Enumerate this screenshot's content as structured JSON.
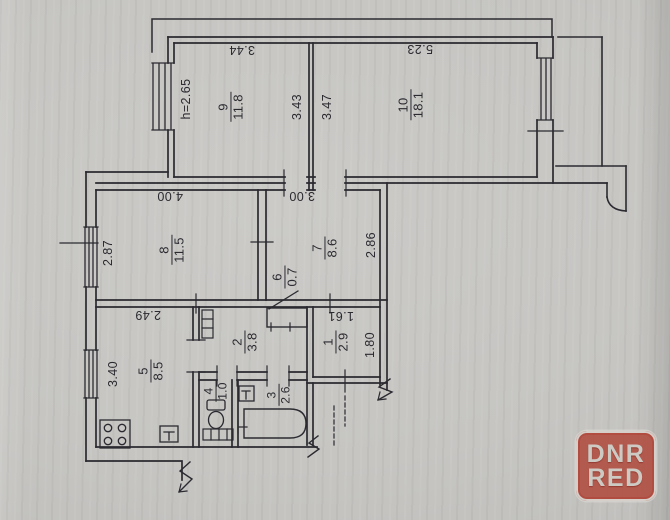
{
  "document": {
    "type": "apartment floor plan (BTI scan)",
    "line_color": "#2b2a30",
    "paper_color": "#c6c5c2"
  },
  "rooms": {
    "r1": {
      "number": "1",
      "area": "2.9"
    },
    "r2": {
      "number": "2",
      "area": "3.8"
    },
    "r3": {
      "number": "3",
      "area": "2.6"
    },
    "r4": {
      "number": "4",
      "area": "1.0"
    },
    "r5": {
      "number": "5",
      "area": "8.5"
    },
    "r6": {
      "number": "6",
      "area": "0.7"
    },
    "r7": {
      "number": "7",
      "area": "8.6"
    },
    "r8": {
      "number": "8",
      "area": "11.5"
    },
    "r9": {
      "number": "9",
      "area": "11.8"
    },
    "r10": {
      "number": "10",
      "area": "18.1"
    }
  },
  "dimensions": {
    "ceiling_height": "h=2.65",
    "room9_width": "3.44",
    "room9_depth": "3.43",
    "room10_width": "5.23",
    "room10_depth": "3.47",
    "room8_width": "4.00",
    "room8_depth": "2.87",
    "room7_width": "3.00",
    "room7_depth": "2.86",
    "kitchen_width": "2.49",
    "kitchen_depth": "3.40",
    "vestibule_width": "1.61",
    "vestibule_depth": "1.80"
  },
  "watermark": {
    "line1": "DNR",
    "line2": "RED",
    "background_color": "#b04b3f",
    "text_color": "#cdcac4"
  }
}
